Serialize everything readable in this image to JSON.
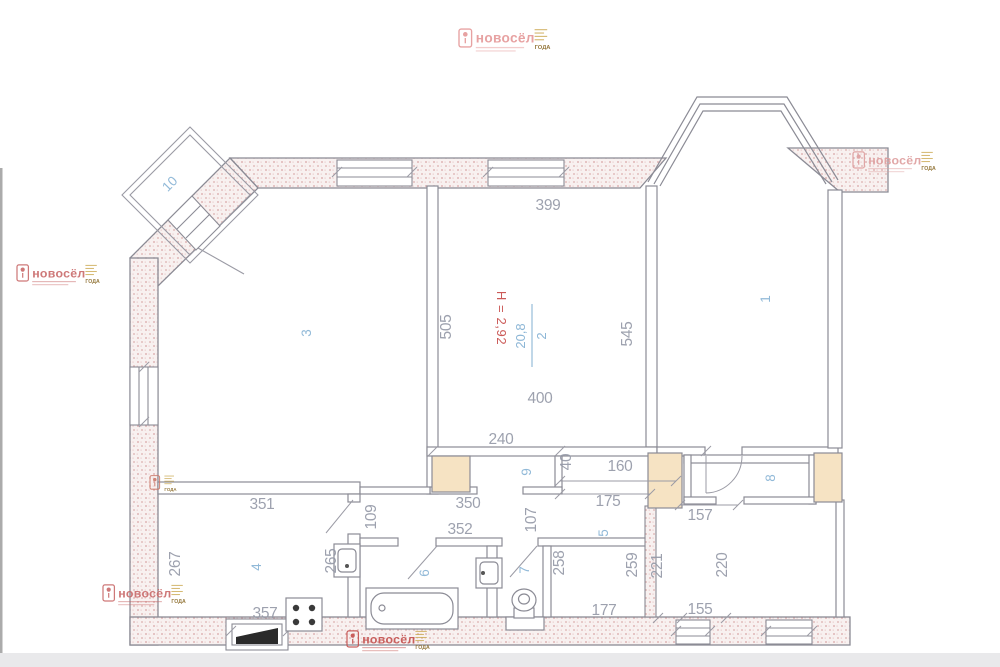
{
  "page": {
    "width": 1000,
    "height": 667,
    "bg": "#ffffff",
    "footer_strip": "#e9e9eb"
  },
  "plan": {
    "colors": {
      "dimension_text": "#959aa8",
      "room_number_text": "#8cb6d6",
      "height_text": "#cb5a58",
      "wall_stroke": "#8b8b95",
      "hatch_dot": "#d8a4a4",
      "hatch_bg": "#f8f1f0",
      "column_fill": "#f6e3c3"
    },
    "height_label": "Н = 2,92",
    "room2_fraction": {
      "num": "2",
      "den": "20,8"
    },
    "dim_labels": [
      {
        "t": "399",
        "x": 548,
        "y": 210,
        "r": 0
      },
      {
        "t": "505",
        "x": 451,
        "y": 327,
        "r": -90
      },
      {
        "t": "545",
        "x": 632,
        "y": 334,
        "r": -90
      },
      {
        "t": "400",
        "x": 540,
        "y": 403,
        "r": 0
      },
      {
        "t": "240",
        "x": 501,
        "y": 444,
        "r": 0
      },
      {
        "t": "40",
        "x": 571,
        "y": 462,
        "r": -90,
        "s": 11
      },
      {
        "t": "160",
        "x": 620,
        "y": 471,
        "r": 0
      },
      {
        "t": "175",
        "x": 608,
        "y": 506,
        "r": 0
      },
      {
        "t": "350",
        "x": 468,
        "y": 508,
        "r": 0
      },
      {
        "t": "351",
        "x": 262,
        "y": 509,
        "r": 0
      },
      {
        "t": "352",
        "x": 460,
        "y": 534,
        "r": 0
      },
      {
        "t": "109",
        "x": 376,
        "y": 517,
        "r": -90
      },
      {
        "t": "107",
        "x": 536,
        "y": 520,
        "r": -90
      },
      {
        "t": "265",
        "x": 336,
        "y": 561,
        "r": -90
      },
      {
        "t": "267",
        "x": 180,
        "y": 564,
        "r": -90
      },
      {
        "t": "258",
        "x": 564,
        "y": 563,
        "r": -90
      },
      {
        "t": "259",
        "x": 637,
        "y": 565,
        "r": -90
      },
      {
        "t": "221",
        "x": 662,
        "y": 566,
        "r": -90
      },
      {
        "t": "220",
        "x": 727,
        "y": 565,
        "r": -90
      },
      {
        "t": "157",
        "x": 700,
        "y": 520,
        "r": 0
      },
      {
        "t": "177",
        "x": 604,
        "y": 615,
        "r": 0
      },
      {
        "t": "155",
        "x": 700,
        "y": 614,
        "r": 0
      },
      {
        "t": "357",
        "x": 265,
        "y": 618,
        "r": 0
      }
    ],
    "room_labels": [
      {
        "t": "1",
        "x": 770,
        "y": 299,
        "r": -90
      },
      {
        "t": "3",
        "x": 311,
        "y": 333,
        "r": -90
      },
      {
        "t": "4",
        "x": 261,
        "y": 567,
        "r": -90
      },
      {
        "t": "5",
        "x": 608,
        "y": 533,
        "r": -90
      },
      {
        "t": "6",
        "x": 429,
        "y": 573,
        "r": -90
      },
      {
        "t": "7",
        "x": 529,
        "y": 570,
        "r": -90
      },
      {
        "t": "8",
        "x": 775,
        "y": 478,
        "r": -90
      },
      {
        "t": "9",
        "x": 531,
        "y": 472,
        "r": -90
      },
      {
        "t": "10",
        "x": 173,
        "y": 187,
        "r": -45
      }
    ]
  },
  "watermark": {
    "brand": "новосёл",
    "badge": "ГОДА",
    "instances": [
      {
        "x": 459,
        "y": 27,
        "s": 1.05,
        "c": "#e59898",
        "variant": "full"
      },
      {
        "x": 853,
        "y": 150,
        "s": 0.95,
        "c": "#de9e9e",
        "variant": "full"
      },
      {
        "x": 17,
        "y": 263,
        "s": 0.95,
        "c": "#c96a6a",
        "variant": "full"
      },
      {
        "x": 103,
        "y": 583,
        "s": 0.95,
        "c": "#c96a6a",
        "variant": "full"
      },
      {
        "x": 347,
        "y": 629,
        "s": 0.95,
        "c": "#c4504e",
        "variant": "full"
      },
      {
        "x": 150,
        "y": 474,
        "s": 0.8,
        "c": "#cc7a6a",
        "variant": "mini"
      }
    ]
  }
}
